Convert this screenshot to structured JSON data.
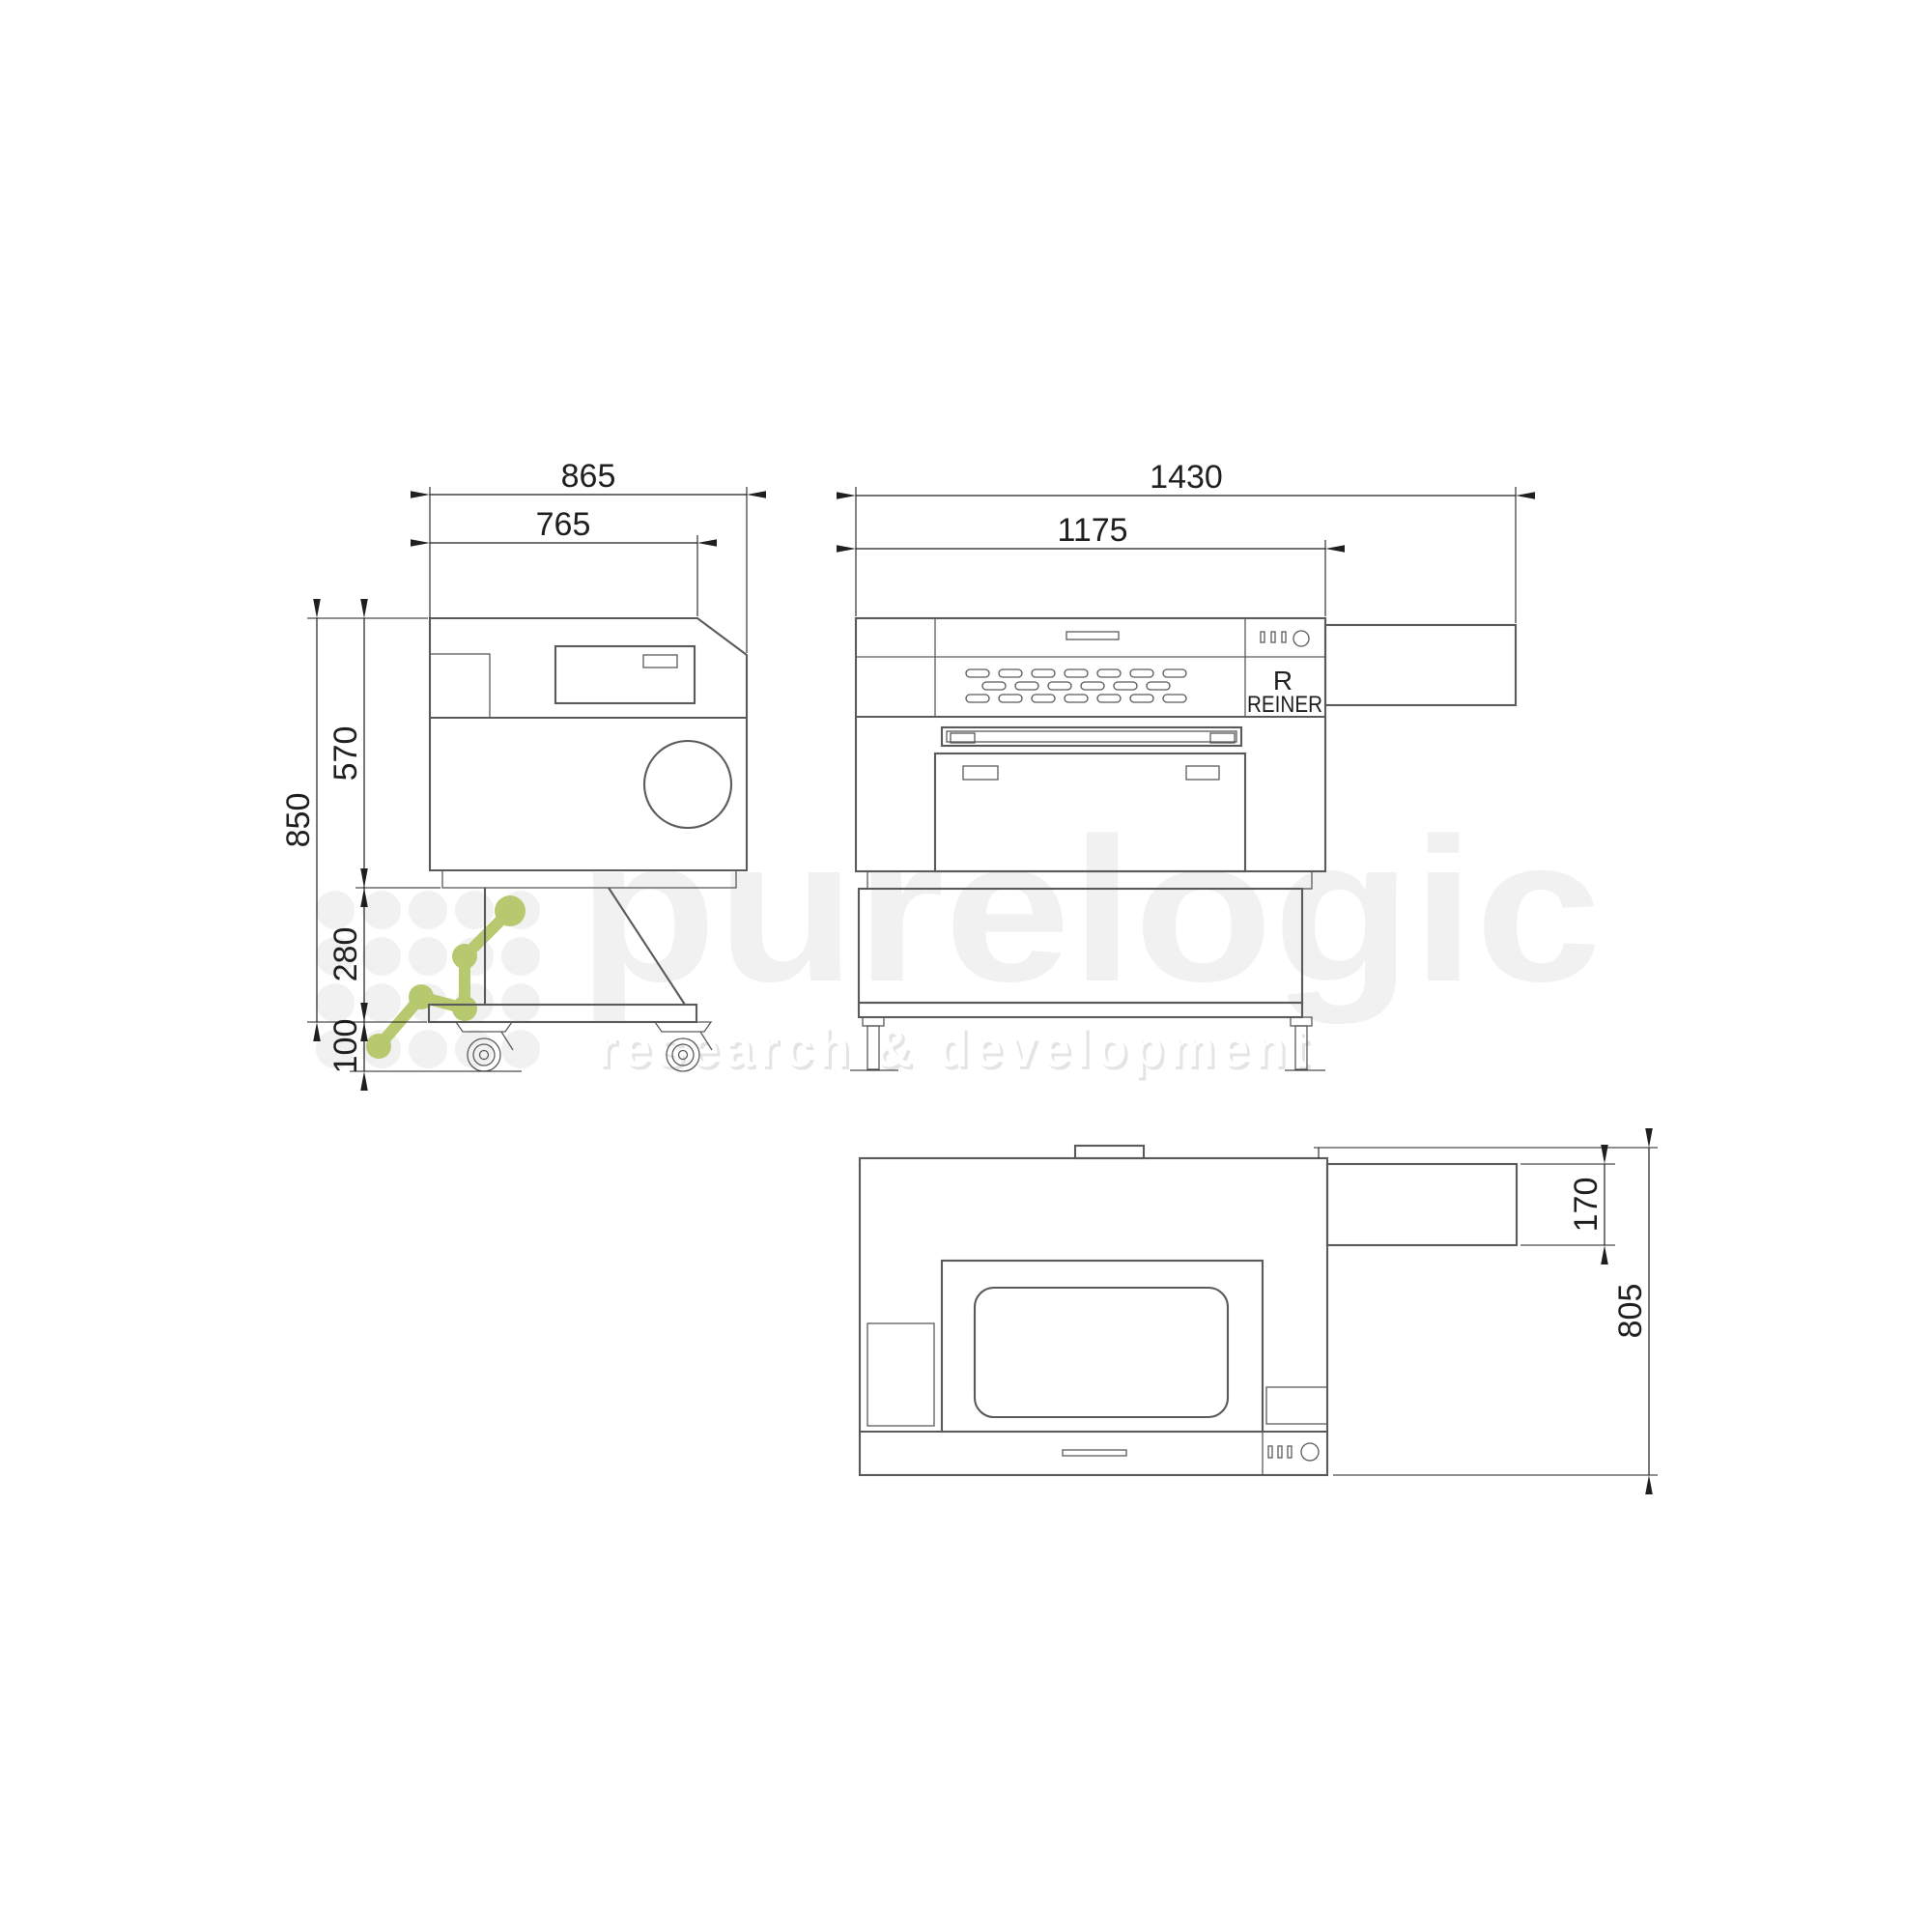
{
  "views": {
    "side": {
      "dims": {
        "total_width": "865",
        "top_width": "765",
        "total_height": "850",
        "body_height": "570",
        "stand_height": "280",
        "caster_height": "100"
      }
    },
    "front": {
      "dims": {
        "total_width": "1430",
        "body_width": "1175"
      },
      "brand_initial": "R",
      "brand_name": "REINER"
    },
    "top": {
      "dims": {
        "duct_depth": "170",
        "total_depth": "805"
      }
    }
  },
  "watermark": {
    "brand": "purelogic",
    "tagline": "research & development"
  },
  "colors": {
    "background": "#ffffff",
    "machine_line": "#5a5a5a",
    "dimension": "#1f1f1f",
    "watermark_text": "#f1f1f1",
    "watermark_shadow": "#e4e4e4",
    "logo_green": "#b6c96f"
  }
}
